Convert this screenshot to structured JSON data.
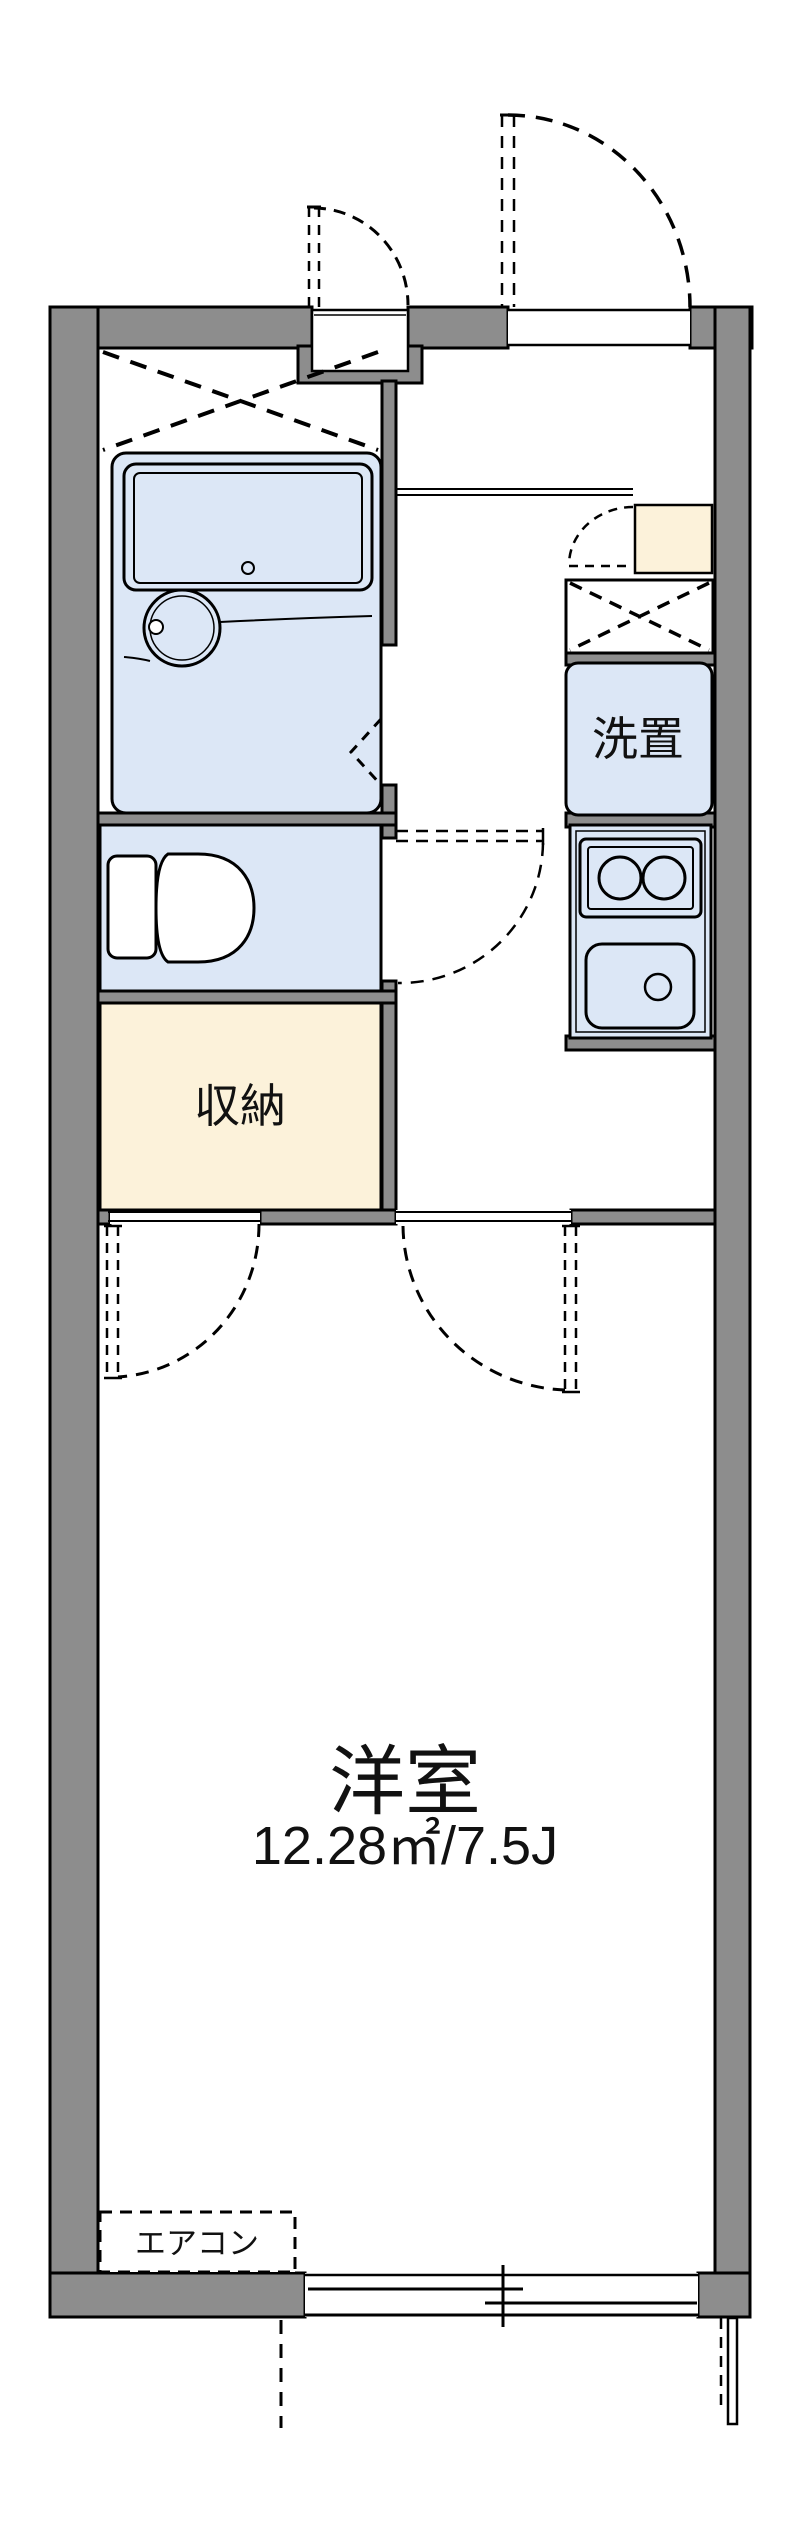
{
  "floorplan": {
    "rooms": {
      "storage_label": "収納",
      "laundry_label": "洗置",
      "western_room_label": "洋室",
      "western_room_area": "12.28㎡/7.5J",
      "aircon_label": "エアコン"
    },
    "colors": {
      "wall": "#8d8d8d",
      "fixture_blue": "#dce7f6",
      "closet_cream": "#fcf2da",
      "line": "#000000",
      "background": "#ffffff"
    },
    "icons": [
      "bathtub-icon",
      "washbasin-icon",
      "toilet-icon",
      "stove-burners-icon",
      "kitchen-sink-icon",
      "sliding-window-icon",
      "door-swing-arc-icon",
      "folding-door-icon",
      "crossed-box-icon"
    ]
  }
}
